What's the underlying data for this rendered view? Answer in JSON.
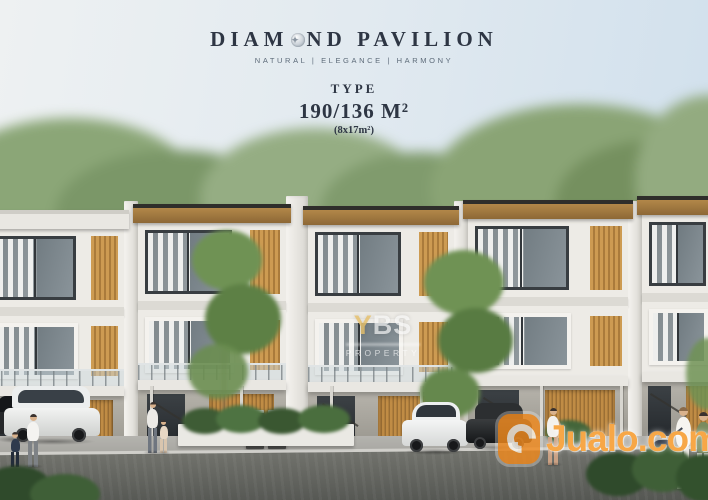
{
  "header": {
    "brand_part1": "DIAM",
    "brand_part2": "ND PAVILION",
    "brand_full_name": "DIAMOND PAVILION",
    "tagline": "NATURAL  |  ELEGANCE  |  HARMONY",
    "type_label": "TYPE",
    "type_size": "190/136 M²",
    "type_plot": "(8x17m²)"
  },
  "watermarks": {
    "center_accent_letter": "Y",
    "center_rest_letters": "BS",
    "center_line2": "PROPERTY",
    "corner_brand": "Jualo.com"
  },
  "palette": {
    "brand-text": "#2e3644",
    "tagline-text": "#5d6b79",
    "sky-top": "#eef1f2",
    "sky-bottom": "#cfdfec",
    "facade-white": "#edebe6",
    "roof-dark": "#2f2e2b",
    "wood-accent": "#cd9b52",
    "foliage": "#7e9a6b",
    "asphalt": "#525450",
    "watermark-orange": "#f18a1e",
    "watermark-white": "#ffffffa8"
  }
}
